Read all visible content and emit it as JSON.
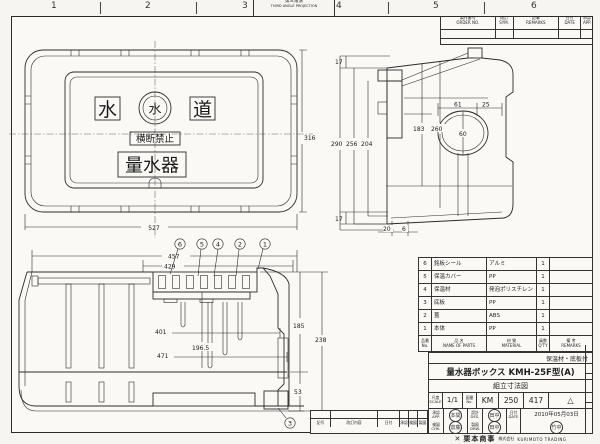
{
  "sheet": {
    "zone_labels": [
      "1",
      "2",
      "3",
      "4",
      "5",
      "6"
    ],
    "projection_jp": "第三角法",
    "projection_en": "THIRD ANGLE PROJECTION"
  },
  "rev_table": {
    "order_no_jp": "製作番号",
    "order_no_en": "ORDER NO.",
    "sym_jp": "改訂",
    "sym_en": "SYM.",
    "remarks_jp": "記事",
    "remarks_en": "REMARKS",
    "date_jp": "日付",
    "date_en": "DATE",
    "app_jp": "承認",
    "app_en": "APP."
  },
  "plan_view": {
    "char_left": "水",
    "logo_char": "水",
    "char_right": "道",
    "warning_label": "横断禁止",
    "meter_label": "量水器",
    "dim_width": "527",
    "dim_height": "316"
  },
  "side_view": {
    "dim_top_17": "17",
    "dim_290": "290",
    "dim_256": "256",
    "dim_204": "204",
    "dim_183": "183",
    "dim_260": "260",
    "dim_61": "61",
    "dim_25": "25",
    "dim_60": "60",
    "dim_bot_17": "17",
    "dim_20": "20",
    "dim_6": "6"
  },
  "section_view": {
    "dim_457": "457",
    "dim_429": "429",
    "dim_401": "401",
    "dim_196_5": "196.5",
    "dim_471": "471",
    "dim_185": "185",
    "dim_238": "238",
    "dim_53": "53",
    "balloons": [
      "6",
      "5",
      "4",
      "2",
      "1"
    ],
    "balloon_bottom": "3"
  },
  "parts": {
    "rows": [
      {
        "no": "6",
        "name": "銘板シール",
        "material": "アルミ",
        "qty": "1",
        "remarks": ""
      },
      {
        "no": "5",
        "name": "保温カバー",
        "material": "PP",
        "qty": "1",
        "remarks": ""
      },
      {
        "no": "4",
        "name": "保温材",
        "material": "発泡ポリスチレン",
        "qty": "1",
        "remarks": ""
      },
      {
        "no": "3",
        "name": "底板",
        "material": "PP",
        "qty": "1",
        "remarks": ""
      },
      {
        "no": "2",
        "name": "蓋",
        "material": "ABS",
        "qty": "1",
        "remarks": ""
      },
      {
        "no": "1",
        "name": "本体",
        "material": "PP",
        "qty": "1",
        "remarks": ""
      }
    ],
    "header": {
      "no_jp": "品番",
      "no_en": "No.",
      "name_jp": "品 名",
      "name_en": "NAME OF PARTS",
      "material_jp": "材 質",
      "material_en": "MATERIAL",
      "qty_jp": "員数",
      "qty_en": "Q'TY",
      "remarks_jp": "備 考",
      "remarks_en": "REMARKS"
    }
  },
  "title_block": {
    "note": "保温材・底板付",
    "product_title": "量水器ボックス KMH-25F型(A)",
    "drawing_title": "組立寸法図",
    "scale_jp": "尺度",
    "scale_en": "SCALE",
    "scale_value": "1/1",
    "dwg_jp": "図番",
    "dwg_en": "No.",
    "dwg_code_1": "KM",
    "dwg_code_2": "250",
    "dwg_code_3": "417",
    "rev_mark": "△",
    "approval_jp": "承認",
    "approval_en": "APP.",
    "check_jp": "検図",
    "check_en": "CHK.",
    "design_jp": "設計",
    "design_en": "DES.",
    "draft_jp": "製図",
    "draft_en": "DRW.",
    "date_jp": "日付",
    "date_en": "DATE",
    "date_value": "2010年05月03日",
    "stamps": [
      "本間",
      "田中",
      "齋藤",
      "田中",
      "竹中"
    ]
  },
  "company": {
    "logo_glyph": "✕",
    "name": "栗本商事",
    "name_suffix": "株式会社",
    "name_en": "KURIMOTO TRADING"
  },
  "bottom_strip": {
    "h_sym": "記号",
    "h_content": "改訂内容",
    "h_date": "日付",
    "h_app": "承認",
    "h_chk": "検図",
    "h_drw": "製図"
  }
}
